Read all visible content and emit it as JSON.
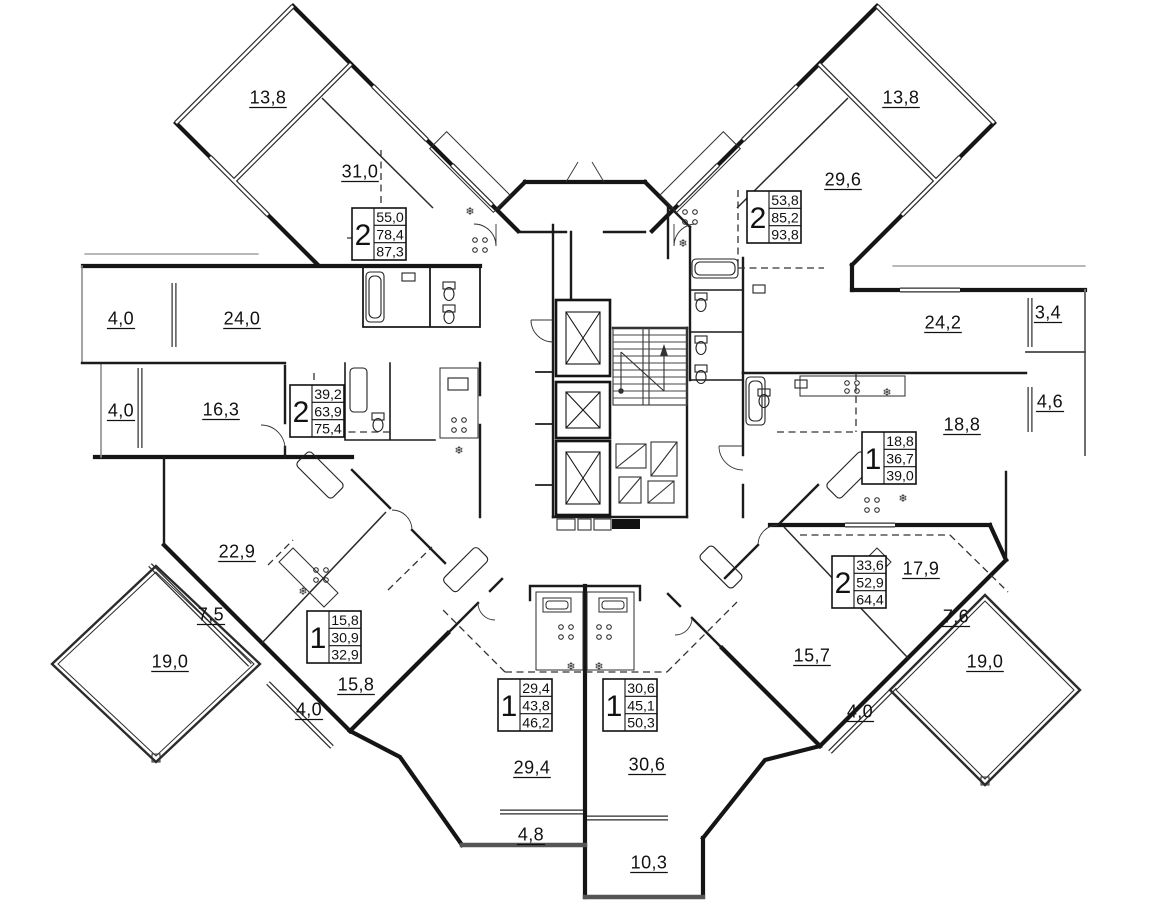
{
  "plan": {
    "type": "residential-floor-plan",
    "colors": {
      "paper": "#ffffff",
      "wall": "#151515",
      "thin": "#2b2b2b",
      "glazing_gap": "#ffffff",
      "grey": "#8d8d8d",
      "parapet": "#555555"
    },
    "icons": {
      "ac_unit": "❄"
    },
    "room_labels": [
      {
        "v": "13,8",
        "x": 268,
        "y": 97
      },
      {
        "v": "31,0",
        "x": 360,
        "y": 171
      },
      {
        "v": "24,0",
        "x": 242,
        "y": 318
      },
      {
        "v": "4,0",
        "x": 121,
        "y": 318
      },
      {
        "v": "4,0",
        "x": 121,
        "y": 410
      },
      {
        "v": "16,3",
        "x": 221,
        "y": 409
      },
      {
        "v": "22,9",
        "x": 237,
        "y": 551
      },
      {
        "v": "7,5",
        "x": 211,
        "y": 614
      },
      {
        "v": "19,0",
        "x": 170,
        "y": 661
      },
      {
        "v": "15,8",
        "x": 356,
        "y": 684
      },
      {
        "v": "4,0",
        "x": 309,
        "y": 709
      },
      {
        "v": "29,4",
        "x": 532,
        "y": 767
      },
      {
        "v": "4,8",
        "x": 531,
        "y": 834
      },
      {
        "v": "30,6",
        "x": 647,
        "y": 764
      },
      {
        "v": "10,3",
        "x": 649,
        "y": 862
      },
      {
        "v": "13,8",
        "x": 901,
        "y": 97
      },
      {
        "v": "29,6",
        "x": 843,
        "y": 179
      },
      {
        "v": "24,2",
        "x": 943,
        "y": 322
      },
      {
        "v": "3,4",
        "x": 1048,
        "y": 312
      },
      {
        "v": "4,6",
        "x": 1050,
        "y": 401
      },
      {
        "v": "18,8",
        "x": 962,
        "y": 424
      },
      {
        "v": "17,9",
        "x": 921,
        "y": 568
      },
      {
        "v": "7,6",
        "x": 956,
        "y": 616
      },
      {
        "v": "19,0",
        "x": 985,
        "y": 661
      },
      {
        "v": "15,7",
        "x": 812,
        "y": 655
      },
      {
        "v": "4,0",
        "x": 860,
        "y": 711
      }
    ],
    "apartments": [
      {
        "rooms": "2",
        "living": "55,0",
        "floor_area": "78,4",
        "total": "87,3",
        "x": 352,
        "y": 208
      },
      {
        "rooms": "2",
        "living": "39,2",
        "floor_area": "63,9",
        "total": "75,4",
        "x": 290,
        "y": 385
      },
      {
        "rooms": "1",
        "living": "15,8",
        "floor_area": "30,9",
        "total": "32,9",
        "x": 307,
        "y": 611
      },
      {
        "rooms": "1",
        "living": "29,4",
        "floor_area": "43,8",
        "total": "46,2",
        "x": 498,
        "y": 679
      },
      {
        "rooms": "1",
        "living": "30,6",
        "floor_area": "45,1",
        "total": "50,3",
        "x": 603,
        "y": 679
      },
      {
        "rooms": "2",
        "living": "53,8",
        "floor_area": "85,2",
        "total": "93,8",
        "x": 747,
        "y": 191
      },
      {
        "rooms": "1",
        "living": "18,8",
        "floor_area": "36,7",
        "total": "39,0",
        "x": 862,
        "y": 432
      },
      {
        "rooms": "2",
        "living": "33,6",
        "floor_area": "52,9",
        "total": "64,4",
        "x": 832,
        "y": 556
      }
    ],
    "ac_units": [
      {
        "x": 470,
        "y": 211
      },
      {
        "x": 683,
        "y": 243
      },
      {
        "x": 459,
        "y": 450
      },
      {
        "x": 887,
        "y": 392
      },
      {
        "x": 303,
        "y": 591
      },
      {
        "x": 903,
        "y": 498
      },
      {
        "x": 571,
        "y": 666
      },
      {
        "x": 599,
        "y": 666
      }
    ]
  }
}
